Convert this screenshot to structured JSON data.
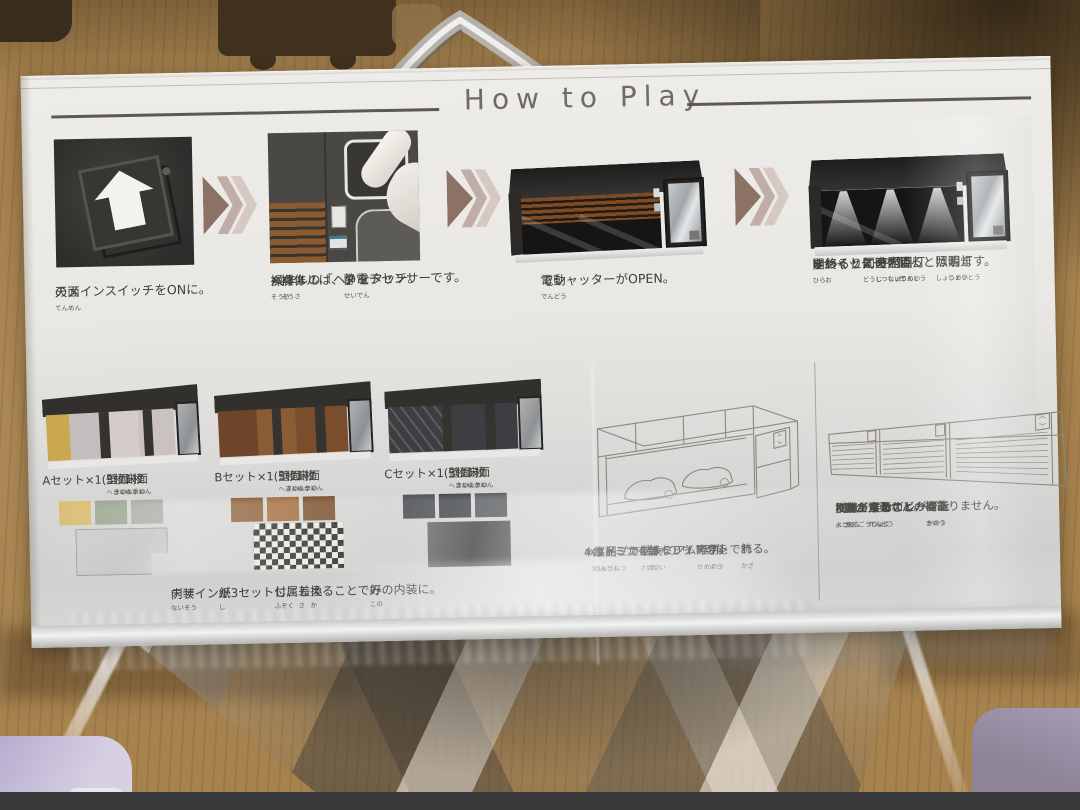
{
  "box": {
    "title": "How to Play",
    "steps": [
      {
        "id": "main-switch-on",
        "caption_lines": [
          "{天面|てんめん}のメインスイッチをONに。"
        ]
      },
      {
        "id": "touch-panel",
        "caption_lines": [
          "{操作|そうさ}パネルの「ヘ」をタッチ。",
          "※{操作|そうさ}パネルは、{静電|せいでん}タッチセンサーです。"
        ]
      },
      {
        "id": "shutter-opens",
        "caption_lines": [
          "{電動|でんどう}でシャッターがOPEN。"
        ]
      },
      {
        "id": "lights-on",
        "caption_lines": [
          "{開|ひら}き{終|お}わると{同時|どうじ}に",
          "ゆっくりと{室内|しつない}の{照明|しょうめい}が{点灯|てんとう}。",
          "※シャッターを{閉|と}じると{照明|しょうめい}は{消灯|しょうとう}します。"
        ]
      }
    ],
    "interior_sets": {
      "sets": [
        {
          "label": "Aセット×1({壁面|へきめん}3{枚|まい}、{床面|ゆかめん}1{枚|まい})",
          "wall_swatches": [
            "#d8bc72",
            "#9aa690",
            "#a9a9a5"
          ],
          "floor_swatch": "light-gray-panel"
        },
        {
          "label": "Bセット×1({壁面|へきめん}3{枚|まい}、{床面|ゆかめん}1{枚|まい})",
          "wall_swatches": [
            "#8a5c35",
            "#a06a3a",
            "#7a4e2c"
          ],
          "floor_swatch": "black-white-checkerboard"
        },
        {
          "label": "Cセット×1({壁面|へきめん}3{枚|まい}、{床面|ゆかめん}1{枚|まい})",
          "wall_swatches": [
            "#4a4d51",
            "#3f4246",
            "#515458"
          ],
          "floor_swatch": "dark-gray-panel"
        }
      ],
      "note": "{内装|ないそう}デザイン{紙|し}が3セット{付属|ふぞく}し、{差|さ}し{換|か}えることで{好|この}みの内装に。"
    },
    "layout_info_lines": [
      "4{台|だい}のトミカを{好|す}きなレイアウトで{飾|かざ}れる。",
      "※{縦列|じゅうれつ}タイプで{最大|さいだい}4{台|だい}レイアウト{可能|かのう}。",
      "※{本品|ほんぴん}はトミカプレミアム{専用|せんよう}です。"
    ],
    "expansion_info_lines": [
      "{別売|べつう}りのトミカガレージを",
      "{横|よこ}に{並|なら}べて{展示|てんじ}することが{可能|かのう}。",
      "※{嵌合力|かんごうりょく}はありません。",
      "※{動|うご}きが{連動|れんどう}するなどの{機能|きのう}はありません。"
    ]
  },
  "colors": {
    "floor_mat": "#a6824e",
    "box_paper": "#eae8e4",
    "chevron_front": "#8b7264",
    "chevron_back": "#bfaea7",
    "shutter_brown": "#8a5a30",
    "text": "#3f3d3a",
    "title_gray": "#6f6b67"
  }
}
